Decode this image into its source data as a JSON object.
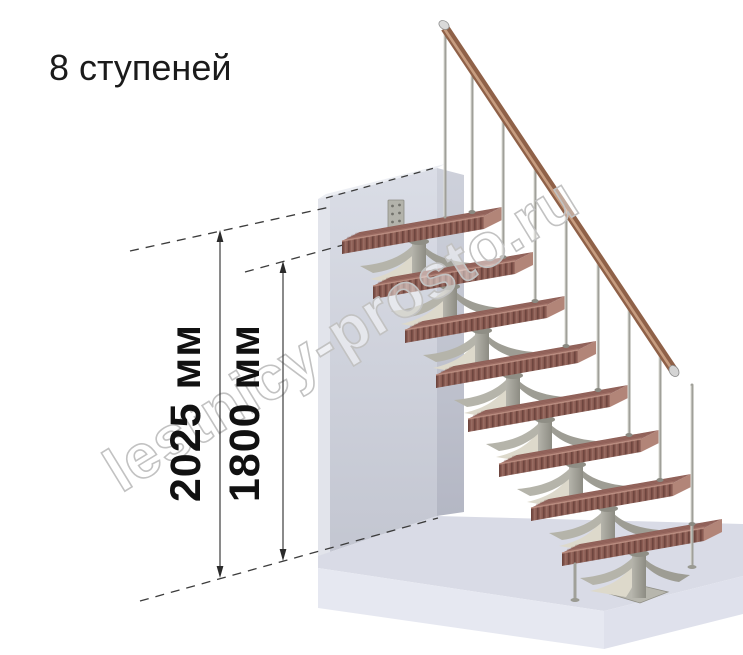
{
  "title": "8 ступеней",
  "watermark": "lestnicy-prosto.ru",
  "dimensions": {
    "floor_to_floor": {
      "label": "2025 мм"
    },
    "floor_to_top_step": {
      "label": "1800 мм"
    }
  },
  "stair": {
    "steps_count": 8,
    "colors": {
      "tread_top": "#9c6c63",
      "tread_front": "#8a5b52",
      "handrail": "#8f6148",
      "frame_gray": "#a3a29a",
      "frame_cream": "#ddd9cb",
      "wall": "#ccd0da",
      "floor": "#d9dbe6",
      "dimension_lines": "#3c3c3c",
      "watermark_outline": "#c2c2c2"
    }
  }
}
